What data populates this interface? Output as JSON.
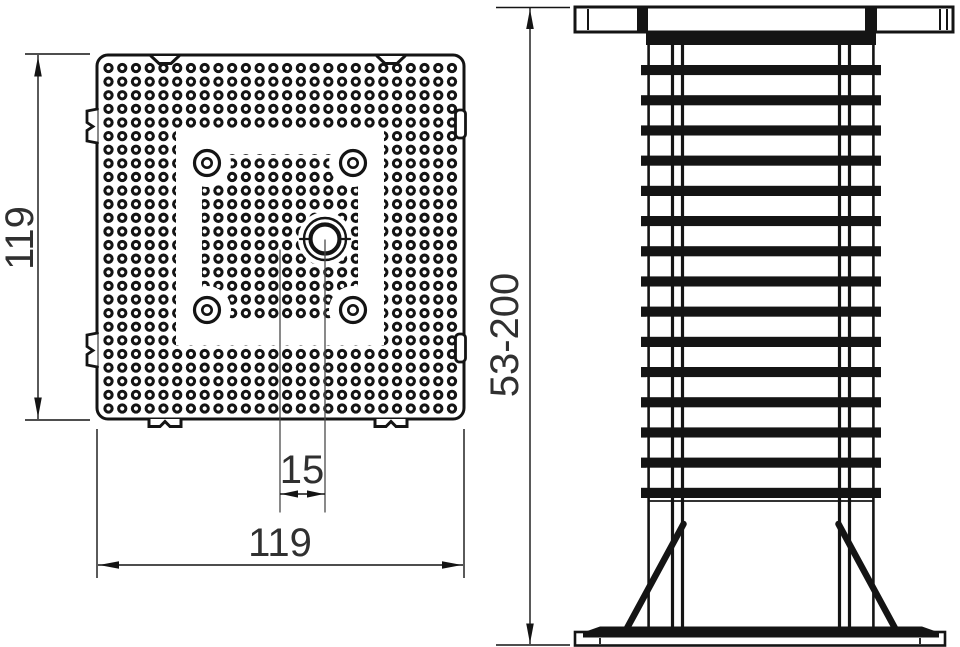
{
  "drawing": {
    "description": "Technical drawing of an adjustable pedestal support: top view of perforated square base plate (left) and side elevation of threaded column with flange, gussets and base plate (right)",
    "colors": {
      "line": "#141414",
      "text": "#303030",
      "background": "#ffffff"
    },
    "top_view": {
      "height_label": "119",
      "width_label": "119",
      "offset_label": "15"
    },
    "side_view": {
      "height_range_label": "53-200"
    }
  }
}
